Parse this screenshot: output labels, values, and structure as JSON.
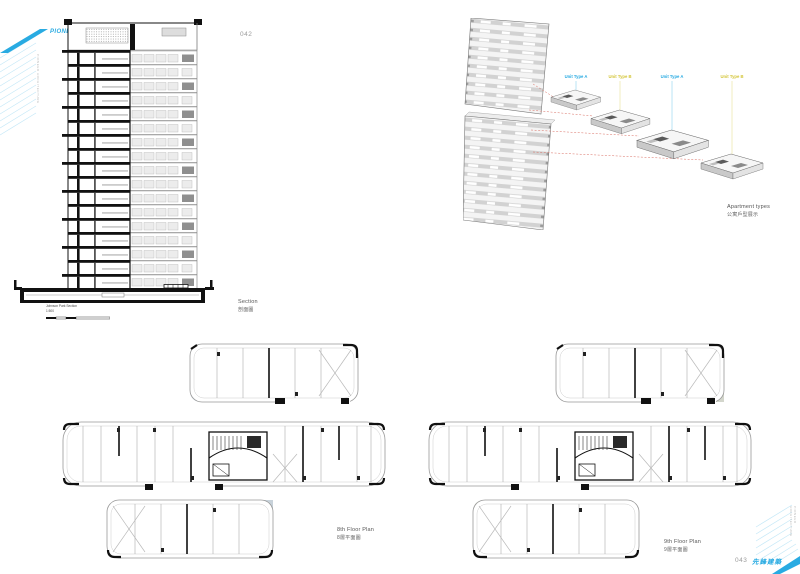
{
  "page": {
    "num_left": "042",
    "num_right": "043"
  },
  "brand": {
    "name": "PIONEER ARCHITECTURE",
    "name_cn": "先鋒建築",
    "accent": "#29abe2",
    "hatch": "#c5e8f7",
    "edge_text_left": "PIONEER ARCHITECTURE",
    "edge_text_right": "PIONEER ARCHITECTURE"
  },
  "section": {
    "label": "Section",
    "label_cn": "剖面圖",
    "caption": "Johnson Park Section",
    "scale": "1:500"
  },
  "axon": {
    "label": "Apartment types",
    "label_cn": "公寓戶型展示",
    "red": "#d96b5f",
    "units": [
      {
        "label": "Unit Type A",
        "color": "#29abe2"
      },
      {
        "label": "Unit Type B",
        "color": "#d4c63a"
      },
      {
        "label": "Unit Type A",
        "color": "#29abe2"
      },
      {
        "label": "Unit Type B",
        "color": "#d4c63a"
      }
    ]
  },
  "plans": [
    {
      "label": "8th Floor Plan",
      "label_cn": "8層平面圖",
      "shade": "#c8d2da"
    },
    {
      "label": "9th Floor Plan",
      "label_cn": "9層平面圖",
      "shade": "#d3d6cc"
    }
  ]
}
